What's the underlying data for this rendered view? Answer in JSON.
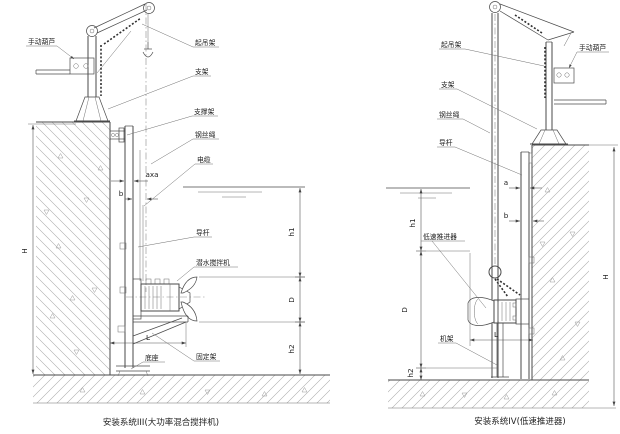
{
  "figure": {
    "line_color": "#4a4a4a",
    "hatch_color": "#9a9a9a",
    "bg_color": "#ffffff",
    "left": {
      "caption": "安装系统III(大功率混合搅拌机)",
      "labels": {
        "manual_hoist": "手动葫芦",
        "lifting_frame": "起吊架",
        "support": "支架",
        "support_frame": "支撑架",
        "wire_rope": "钢丝绳",
        "cable": "电缆",
        "guide_rod": "导杆",
        "mixer": "潜水搅拌机",
        "base": "底座",
        "fixing_frame": "固定架"
      },
      "dims": {
        "H": "H",
        "h1": "h1",
        "D": "D",
        "h2": "h2",
        "L": "L",
        "b": "b",
        "axa": "axa"
      }
    },
    "right": {
      "caption": "安装系统IV(低速推进器)",
      "labels": {
        "manual_hoist": "手动葫芦",
        "lifting_frame": "起吊架",
        "support": "支架",
        "wire_rope": "钢丝绳",
        "guide_rod": "导杆",
        "thruster": "低速推进器",
        "machine_frame": "机架"
      },
      "dims": {
        "H": "H",
        "h1": "h1",
        "D": "D",
        "h2": "h2",
        "L": "L",
        "a": "a",
        "b": "b"
      }
    }
  }
}
